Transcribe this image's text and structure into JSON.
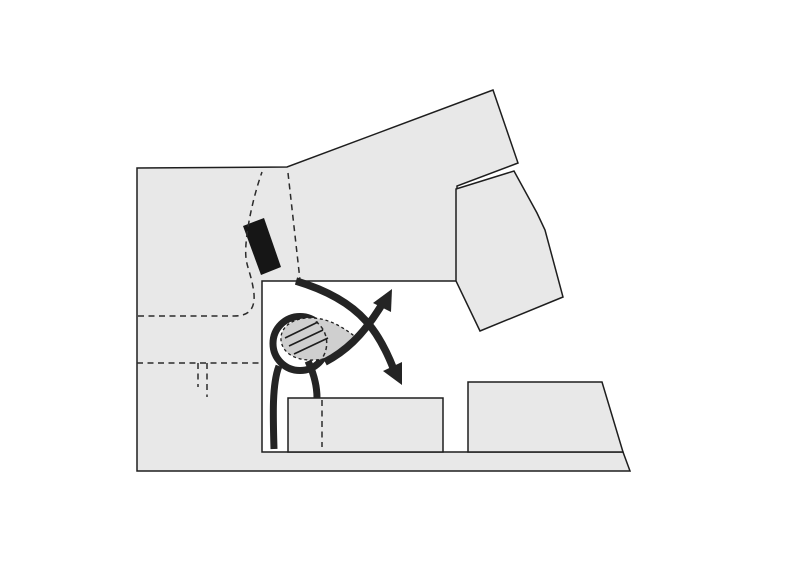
{
  "canvas": {
    "width": 800,
    "height": 567,
    "background": "#ffffff"
  },
  "figure": {
    "description_name": "architectural-site-plan-concept-diagram",
    "palette": {
      "building": "#e8e8e8",
      "leaf": "#cfcfcf",
      "outline": "#1e1e1e",
      "flow": "#242424",
      "bar": "#161616",
      "dashline": "#2b2b2b"
    },
    "elements": [
      {
        "name": "building-main",
        "type": "polygon",
        "points": "137,168 287,167 493,90 518,163 457,186 457,281 262,281 262,452 623,452 630,471 137,471",
        "fill": "building",
        "stroke": "outline",
        "sw": 1.5
      },
      {
        "name": "building-right",
        "type": "polygon",
        "points": "456,189 514,171 537,213 545,230 563,297 480,331 456,281",
        "fill": "building",
        "stroke": "outline",
        "sw": 1.5
      },
      {
        "name": "building-lower-center",
        "type": "polygon",
        "points": "288,398 443,398 443,452 288,452",
        "fill": "building",
        "stroke": "outline",
        "sw": 1.5
      },
      {
        "name": "building-lower-right",
        "type": "polygon",
        "points": "468,382 602,382 623,452 468,452",
        "fill": "building",
        "stroke": "outline",
        "sw": 1.5
      },
      {
        "name": "passage-bar",
        "type": "polygon",
        "points": "243,226 264,218 281,267 261,275",
        "fill": "bar"
      },
      {
        "name": "dashed-path-walk-west",
        "type": "path",
        "d": "M138,316 L234,316 C250,316 255,308 254,294 C252,276 247,268 246,258 C244,240 252,200 262,172",
        "stroke": "dashline",
        "sw": 1.5,
        "dash": "6 4.5"
      },
      {
        "name": "dashed-path-passage-right-flank",
        "type": "path",
        "d": "M288,173 L300,280",
        "stroke": "dashline",
        "sw": 1.5,
        "dash": "6 4.5"
      },
      {
        "name": "dashed-path-walk-lower",
        "type": "path",
        "d": "M137,363 L262,363",
        "stroke": "dashline",
        "sw": 1.5,
        "dash": "6 4.5"
      },
      {
        "name": "dashed-stub-left",
        "type": "path",
        "d": "M198,363 L198,387",
        "stroke": "dashline",
        "sw": 1.5,
        "dash": "6 4.5"
      },
      {
        "name": "dashed-stub-right",
        "type": "path",
        "d": "M207,363 L207,397",
        "stroke": "dashline",
        "sw": 1.5,
        "dash": "6 4.5"
      },
      {
        "name": "dashed-path-plaza-vertical",
        "type": "path",
        "d": "M322,400 L322,447",
        "stroke": "dashline",
        "sw": 1.5,
        "dash": "6 4.5"
      },
      {
        "name": "flow-ring",
        "type": "circle",
        "cx": 300,
        "cy": 343.5,
        "r": 27,
        "fill": "none",
        "stroke": "flow",
        "sw": 7
      },
      {
        "name": "flow-stem-channel",
        "type": "path",
        "d": "M279,366 C272,384 273,415 274,449",
        "stroke": "flow",
        "sw": 7
      },
      {
        "name": "flow-stem-plaza",
        "type": "path",
        "d": "M308,361 C314,374 317,386 317,398",
        "stroke": "flow",
        "sw": 7
      },
      {
        "name": "leaf-shape",
        "type": "path",
        "d": "M358,339 C340,324 324,317 307,318 C291,319 280,328 281,340 C282,352 294,360 310,360 C327,361 342,353 358,339 Z",
        "fill": "leaf",
        "stroke": "outline",
        "sw": 1.3,
        "dash": "3 2.8"
      },
      {
        "name": "leaf-hidden-ring-arc",
        "type": "path",
        "d": "M315.8,321.5 A27 27 0 0 1 320,361",
        "fill": "none",
        "stroke": "dashline",
        "sw": 1.5,
        "dash": "4 3"
      },
      {
        "name": "leaf-rib-1",
        "type": "path",
        "d": "M285,338 L318,322",
        "stroke": "outline",
        "sw": 1.6
      },
      {
        "name": "leaf-rib-2",
        "type": "path",
        "d": "M289,346 L323,330",
        "stroke": "outline",
        "sw": 1.6
      },
      {
        "name": "leaf-rib-3",
        "type": "path",
        "d": "M294,354 L328,338",
        "stroke": "outline",
        "sw": 1.6
      },
      {
        "name": "flow-curve-southeast",
        "type": "path",
        "d": "M296,281 C326,290 350,303 366,321 C377,333 387,352 394,370",
        "stroke": "flow",
        "sw": 7.5
      },
      {
        "name": "arrowhead-southeast",
        "type": "polygon",
        "points": "402,385 402,362 383,371",
        "fill": "flow"
      },
      {
        "name": "flow-line-northeast",
        "type": "path",
        "d": "M325,362 C344,352 362,337 381,306",
        "stroke": "flow",
        "sw": 7.5
      },
      {
        "name": "arrowhead-northeast",
        "type": "polygon",
        "points": "392,289 373,303 391,312",
        "fill": "flow"
      }
    ]
  }
}
